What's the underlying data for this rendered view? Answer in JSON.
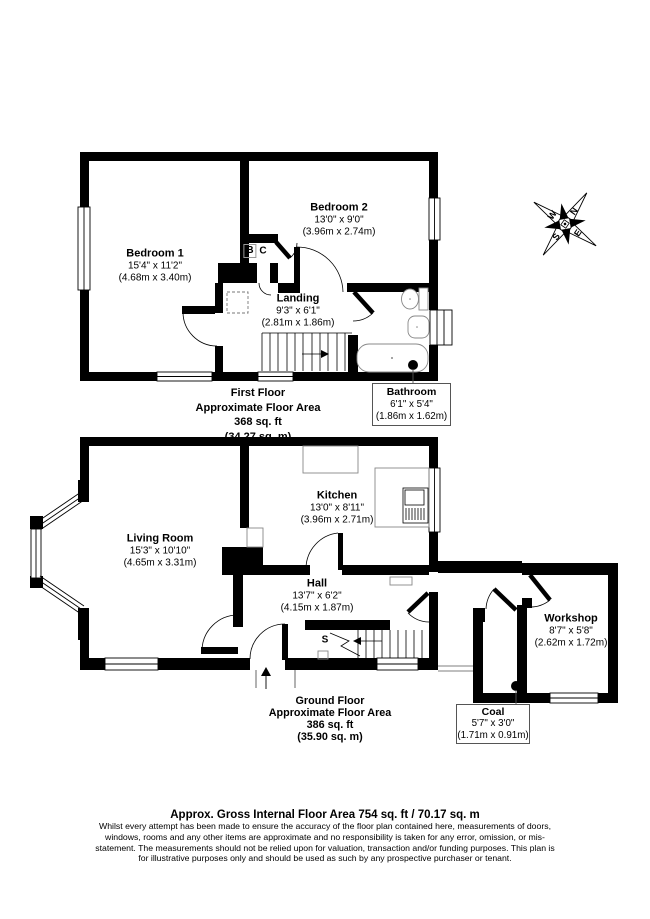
{
  "footer": {
    "gross_area": "Approx. Gross Internal Floor Area 754 sq. ft / 70.17 sq. m",
    "disclaimer": "Whilst every attempt has been made to ensure the accuracy of the floor plan contained here, measurements of doors, windows, rooms and any other items are approximate and no responsibility is taken for any error, omission, or mis-statement. The measurements should not be relied upon for valuation, transaction and/or funding purposes. This plan is for illustrative purposes only and should be used as such by any prospective purchaser or tenant."
  },
  "first_floor": {
    "summary": {
      "line1": "First Floor",
      "line2": "Approximate Floor Area",
      "line3": "368 sq. ft",
      "line4": "(34.27 sq. m)"
    },
    "bedroom1": {
      "name": "Bedroom 1",
      "size_ft": "15'4\" x 11'2\"",
      "size_m": "(4.68m x 3.40m)"
    },
    "bedroom2": {
      "name": "Bedroom 2",
      "size_ft": "13'0\" x 9'0\"",
      "size_m": "(3.96m x 2.74m)"
    },
    "landing": {
      "name": "Landing",
      "size_ft": "9'3\" x 6'1\"",
      "size_m": "(2.81m x 1.86m)"
    },
    "bathroom": {
      "name": "Bathroom",
      "size_ft": "6'1\" x 5'4\"",
      "size_m": "(1.86m x 1.62m)"
    },
    "cupboard_b": "B",
    "cupboard_c": "C"
  },
  "ground_floor": {
    "summary": {
      "line1": "Ground Floor",
      "line2": "Approximate Floor Area",
      "line3": "386 sq. ft",
      "line4": "(35.90 sq. m)"
    },
    "living_room": {
      "name": "Living Room",
      "size_ft": "15'3\" x 10'10\"",
      "size_m": "(4.65m x 3.31m)"
    },
    "kitchen": {
      "name": "Kitchen",
      "size_ft": "13'0\" x 8'11\"",
      "size_m": "(3.96m x 2.71m)"
    },
    "hall": {
      "name": "Hall",
      "size_ft": "13'7\" x 6'2\"",
      "size_m": "(4.15m x 1.87m)"
    },
    "workshop": {
      "name": "Workshop",
      "size_ft": "8'7\" x 5'8\"",
      "size_m": "(2.62m x 1.72m)"
    },
    "coal": {
      "name": "Coal",
      "size_ft": "5'7\" x 3'0\"",
      "size_m": "(1.71m x 0.91m)"
    },
    "stairs_label": "S"
  },
  "compass": {
    "n": "N",
    "e": "E",
    "s": "S",
    "w": "W"
  },
  "colors": {
    "wall": "#000000",
    "background": "#ffffff"
  }
}
